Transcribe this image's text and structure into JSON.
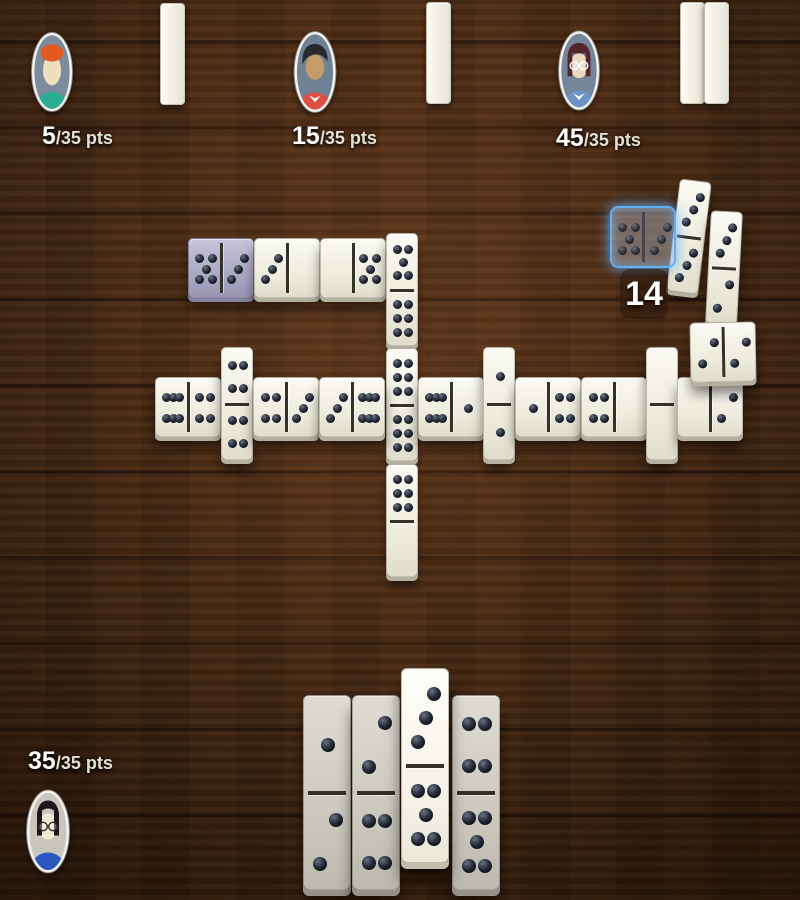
{
  "colors": {
    "pip_dark": "#12161f",
    "pip_red": "#d8333e",
    "highlight_blue": "#5fb0f6",
    "last_played_tint": "#aaa7c3",
    "score_text": "#ffffff"
  },
  "players": [
    {
      "id": "opponent-1",
      "score": "5",
      "score_suffix": "/35 pts",
      "tiles_remaining": 1,
      "avatar": {
        "bg": "#7b8b9c",
        "hair": "#e2581f",
        "skin": "#eee0bf",
        "shirt": "#2aae8f",
        "hair_style": "cap",
        "glasses": false
      },
      "rack": [
        {
          "x": 160,
          "y": 3
        }
      ]
    },
    {
      "id": "opponent-2",
      "score": "15",
      "score_suffix": "/35 pts",
      "tiles_remaining": 1,
      "avatar": {
        "bg": "#6f8195",
        "hair": "#27292f",
        "skin": "#c59c68",
        "shirt": "#dd4f43",
        "hair_style": "swoosh",
        "glasses": false,
        "collar": "#ffffff"
      },
      "rack": [
        {
          "x": 426,
          "y": 2
        }
      ]
    },
    {
      "id": "opponent-3",
      "score": "45",
      "score_suffix": "/35 pts",
      "tiles_remaining": 2,
      "avatar": {
        "bg": "#75869a",
        "hair": "#54262b",
        "skin": "#ead9bf",
        "shirt": "#6d93c5",
        "hair_style": "sides",
        "glasses": true,
        "glasses_color": "#ffffff",
        "collar": "#ffffff"
      },
      "rack": [
        {
          "x": 680,
          "y": 2
        },
        {
          "x": 704,
          "y": 2
        }
      ]
    },
    {
      "id": "player",
      "score": "35",
      "score_suffix": "/35 pts",
      "avatar": {
        "bg": "#c9c6bd",
        "hair": "#1b171c",
        "skin": "#f1ead0",
        "shirt": "#2b57c0",
        "hair_style": "part",
        "glasses": true,
        "glasses_color": "#2a2a2a"
      }
    }
  ],
  "board": {
    "preview_points": "14",
    "tiles": [
      {
        "x": 188,
        "y": 238,
        "o": "h",
        "a": 5,
        "b": 3,
        "style": "purple"
      },
      {
        "x": 254,
        "y": 238,
        "o": "h",
        "a": 3,
        "b": 0,
        "ac": "red"
      },
      {
        "x": 320,
        "y": 238,
        "o": "h",
        "a": 0,
        "b": 5
      },
      {
        "x": 386,
        "y": 233,
        "o": "v",
        "a": 5,
        "b": 6
      },
      {
        "x": 386,
        "y": 348,
        "o": "v",
        "a": 6,
        "b": 6
      },
      {
        "x": 386,
        "y": 464,
        "o": "v",
        "a": 6,
        "b": 0
      },
      {
        "x": 155,
        "y": 377,
        "o": "h",
        "a": 6,
        "b": 4,
        "ac": "red"
      },
      {
        "x": 221,
        "y": 347,
        "o": "v",
        "a": 4,
        "b": 4
      },
      {
        "x": 253,
        "y": 377,
        "o": "h",
        "a": 4,
        "b": 3
      },
      {
        "x": 319,
        "y": 377,
        "o": "h",
        "a": 3,
        "b": 6
      },
      {
        "x": 418,
        "y": 377,
        "o": "h",
        "a": 6,
        "b": 1
      },
      {
        "x": 483,
        "y": 347,
        "o": "v",
        "a": 1,
        "b": 1
      },
      {
        "x": 515,
        "y": 377,
        "o": "h",
        "a": 1,
        "b": 4
      },
      {
        "x": 581,
        "y": 377,
        "o": "h",
        "a": 4,
        "b": 0
      },
      {
        "x": 646,
        "y": 347,
        "o": "v",
        "a": 0,
        "b": 0
      },
      {
        "x": 677,
        "y": 377,
        "o": "h",
        "a": 0,
        "b": 2
      },
      {
        "x": 673,
        "y": 180,
        "o": "v",
        "a": 3,
        "b": 3,
        "rot": 7
      },
      {
        "x": 708,
        "y": 211,
        "o": "v",
        "a": 3,
        "b": 2,
        "rot": 3
      },
      {
        "x": 690,
        "y": 322,
        "o": "h",
        "a": 2,
        "b": 2,
        "rot": -1
      }
    ],
    "preview_tile": {
      "x": 610,
      "y": 206,
      "o": "h",
      "a": 5,
      "b": 3,
      "ac": "red",
      "w": 66,
      "h": 62
    }
  },
  "hand": {
    "tiles": [
      {
        "x": 303,
        "y": 695,
        "a": 1,
        "b": 2,
        "selected": false
      },
      {
        "x": 352,
        "y": 695,
        "a": 2,
        "b": 4,
        "selected": false
      },
      {
        "x": 401,
        "y": 668,
        "a": 3,
        "b": 5,
        "bc": "red",
        "selected": true
      },
      {
        "x": 452,
        "y": 695,
        "a": 4,
        "b": 5,
        "selected": false
      }
    ]
  }
}
